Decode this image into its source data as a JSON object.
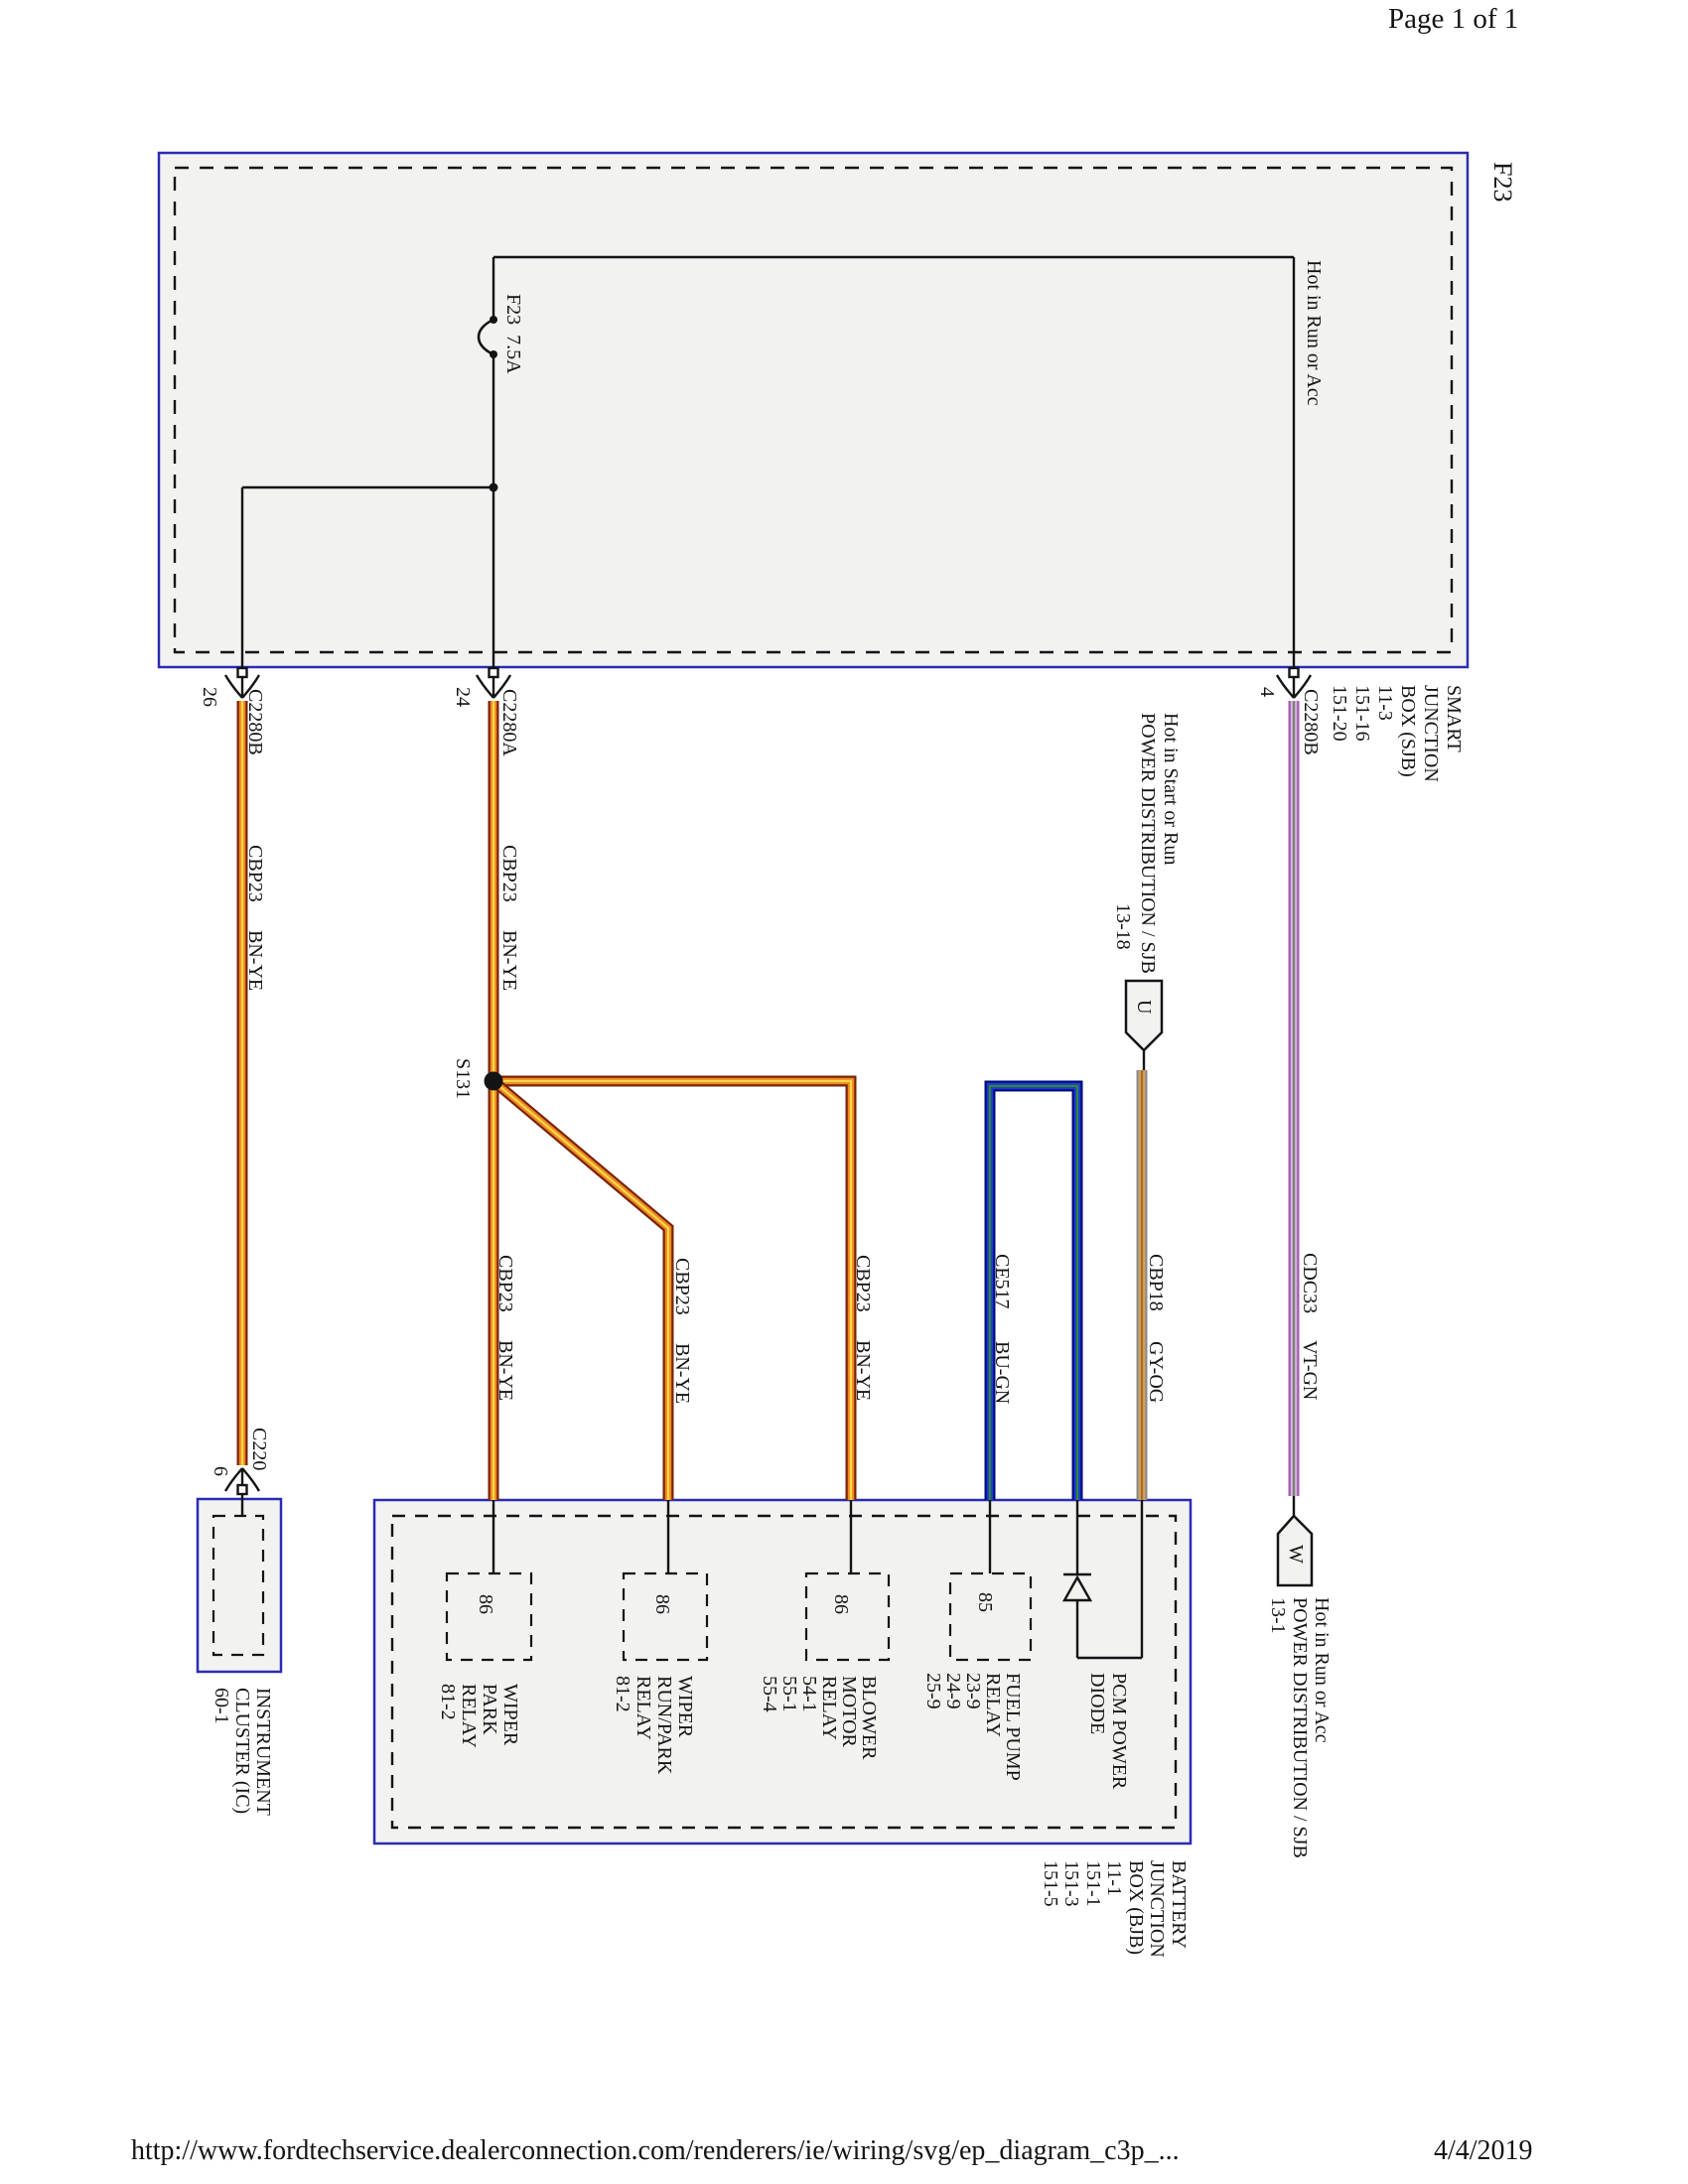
{
  "page": {
    "header": "Page 1 of 1",
    "footer_url": "http://www.fordtechservice.dealerconnection.com/renderers/ie/wiring/svg/ep_diagram_c3p_...",
    "footer_date": "4/4/2019"
  },
  "colors": {
    "box_border": "#2b2bb4",
    "box_fill": "#f2f2f1",
    "line": "#141414"
  },
  "sjb_box": {
    "tag": "F23",
    "bus_label": "Hot in Run or Acc",
    "fuse_label": "F23  7.5A",
    "ref_block": "SMART\nJUNCTION\nBOX (SJB)\n11-3\n151-16\n151-20"
  },
  "connectors": {
    "c2280b_26": {
      "pin": "26",
      "name": "C2280B"
    },
    "c2280a_24": {
      "pin": "24",
      "name": "C2280A"
    },
    "c2280b_4": {
      "pin": "4",
      "name": "C2280B"
    },
    "c220_6": {
      "pin": "6",
      "name": "C220"
    }
  },
  "splice": {
    "name": "S131"
  },
  "wire_types": {
    "bnye": {
      "circuit": "CBP23",
      "code": "BN-YE",
      "outer_hex": "#7b2309",
      "mid_hex": "#ef8a1f",
      "stripe_hex": "#ffd84d"
    },
    "bugn": {
      "circuit": "CE517",
      "code": "BU-GN",
      "outer_hex": "#000d7d",
      "mid_hex": "#2038d8",
      "stripe_hex": "#2e8b2e"
    },
    "gyog": {
      "circuit": "CBP18",
      "code": "GY-OG",
      "outer_hex": "#8c8c8c",
      "mid_hex": "#d1a45c",
      "stripe_hex": "#b06a20"
    },
    "vtgn": {
      "circuit": "CDC33",
      "code": "VT-GN",
      "outer_hex": "#a35cae",
      "mid_hex": "#dcaede",
      "stripe_hex": "#6e8a6e"
    }
  },
  "power_refs": {
    "u": {
      "letter": "U",
      "lines": "Hot in Start or Run\nPOWER DISTRIBUTION / SJB",
      "page_ref": "13-18"
    },
    "w": {
      "letter": "W",
      "lines": "Hot in Run or Acc\nPOWER DISTRIBUTION / SJB\n13-1"
    }
  },
  "ic_box": {
    "label": "INSTRUMENT\nCLUSTER (IC)\n60-1"
  },
  "bjb_box": {
    "ref_block": "BATTERY\nJUNCTION\nBOX (BJB)\n11-1\n151-1\n151-3\n151-5",
    "relays": {
      "wiper_park": {
        "pin": "86",
        "label": "WIPER\nPARK\nRELAY\n81-2"
      },
      "wiper_runpark": {
        "pin": "86",
        "label": "WIPER\nRUN/PARK\nRELAY\n81-2"
      },
      "blower": {
        "pin": "86",
        "label": "BLOWER\nMOTOR\nRELAY\n54-1\n55-1\n55-4"
      },
      "fuel_pump": {
        "pin": "85",
        "label": "FUEL PUMP\nRELAY\n23-9\n24-9\n25-9"
      },
      "pcm_diode": {
        "label": "PCM POWER\nDIODE"
      }
    }
  }
}
